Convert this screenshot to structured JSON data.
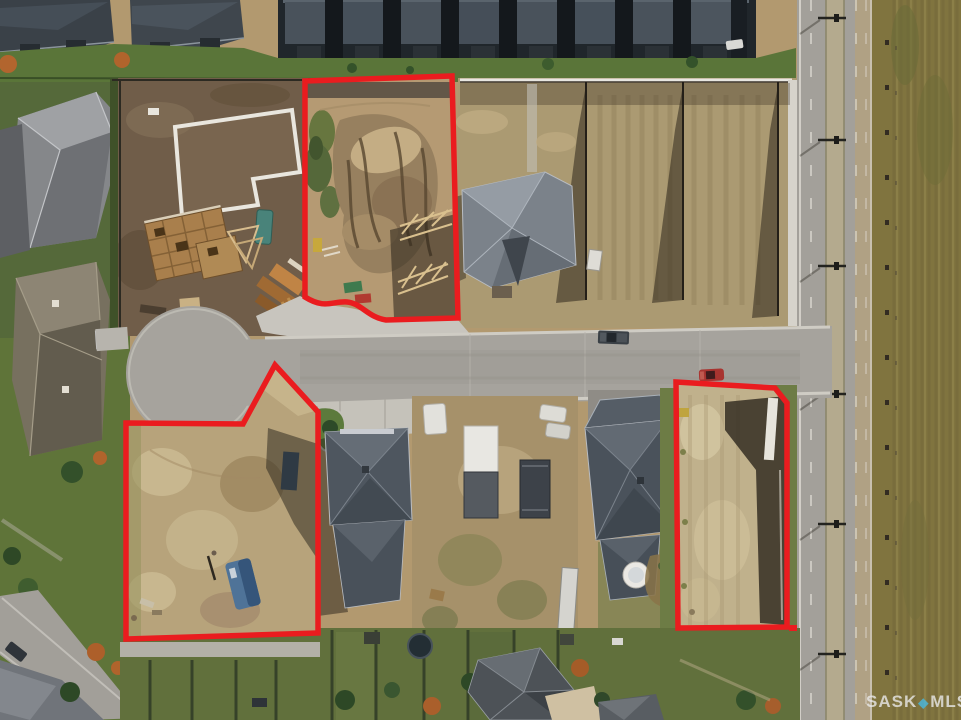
{
  "meta": {
    "kind": "aerial-drone-real-estate-photo",
    "description": "Aerial view of a suburban cul-de-sac development with three vacant lots for sale outlined in red",
    "width": 961,
    "height": 720
  },
  "outline": {
    "color": "#ea1c1f",
    "width": 5.5
  },
  "lots": [
    {
      "name": "north-lot",
      "path": "M305,81 L452,76 L458,318 L386,320 C368,317.5 361,303 347,302 C332,301 325,309.5 305,297 Z"
    },
    {
      "name": "southwest-lot",
      "path": "M126,423 L243,424 L275,365 L318,412 L318,633 L126,639 Z"
    },
    {
      "name": "southeast-lot",
      "path": "M676,382 L775,388 L787,403 L787,627 L678,628 Z"
    }
  ],
  "watermark": {
    "brand_primary": "SASK",
    "separator_icon": "diamond",
    "separator_glyph": "◆",
    "brand_secondary": "MLS",
    "registered_symbol": "®",
    "text_color": "#e9e9e9",
    "diamond_color": "#49b9e0",
    "opacity": 0.8
  }
}
